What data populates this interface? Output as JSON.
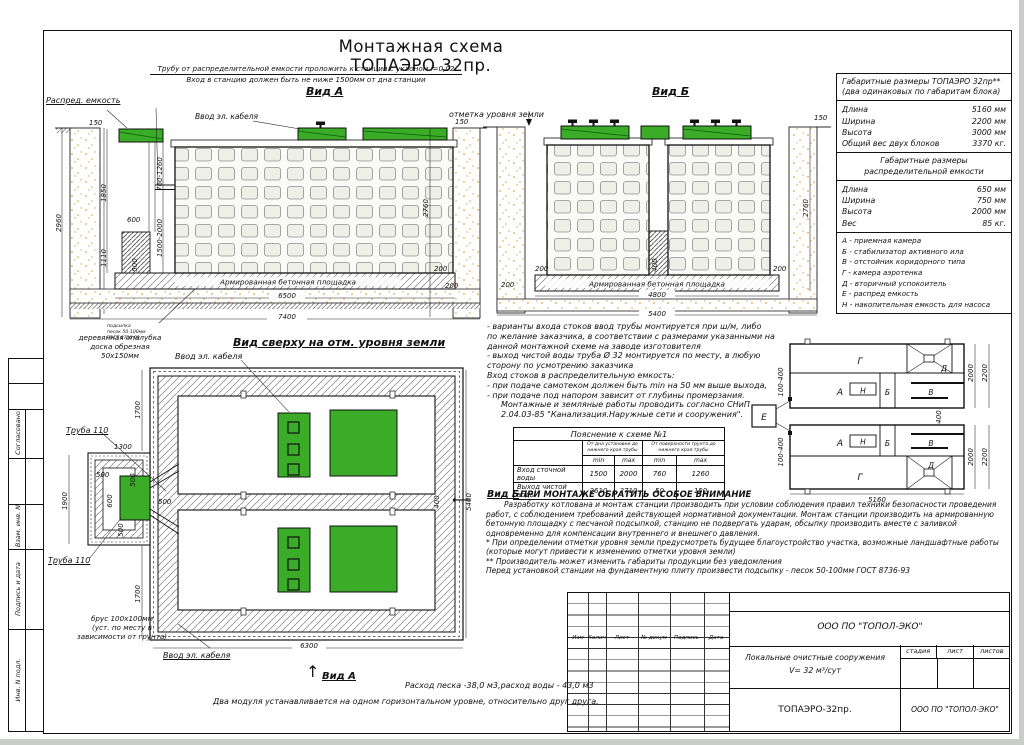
{
  "title": "Монтажная схема ТОПАЭРО 32пр.",
  "colors": {
    "green": "#3aac28"
  },
  "stamp_col": {
    "c1": "Согласовано",
    "c2": "Взам. инв. N",
    "c3": "Подпись и дата",
    "c4": "Инв. N подл."
  },
  "view_a": {
    "label": "Вид А",
    "pipe_note1": "Трубу от распределительной емкости проложить к станции с уклоном i=0,02",
    "pipe_note2": "Вход в станцию должен быть не ниже 1500мм от дна станции",
    "distrib": "Распред. емкость",
    "cable": "Ввод эл. кабеля",
    "ground": "отметка уровня земли",
    "slab": "Армированная бетонная площадка",
    "sand_note": [
      "подсыпка",
      "песок 50-100мм",
      "ГОСТ 8736-93"
    ],
    "formwork_note": [
      "деревянная опалубка",
      "доска обрезная",
      "50х150мм"
    ],
    "dims": {
      "h150l": "150",
      "v2960": "2960",
      "v1850": "1850",
      "h600": "600",
      "v1110": "1110",
      "v760": "760-1260",
      "v1500": "1500-2000",
      "v500": "500",
      "h150r": "150",
      "v2760": "2760",
      "h200a": "200",
      "h200b": "200",
      "w6500": "6500",
      "w7400": "7400"
    }
  },
  "view_b": {
    "label": "Вид Б",
    "slab": "Армированная бетонная площадка",
    "dims": {
      "h150": "150",
      "v2760": "2760",
      "h200l": "200",
      "v400": "400",
      "h200r": "200",
      "h200b": "200",
      "w4800": "4800",
      "w5400": "5400"
    }
  },
  "plan": {
    "heading": "Вид сверху на отм. уровня земли",
    "cable_top": "Ввод эл. кабеля",
    "cable_bottom": "Ввод эл. кабеля",
    "pipe1": "Труба 110",
    "pipe2": "Труба 110",
    "beam_note": [
      "брус 100х100мм",
      "(уст. по месту в",
      "зависимости от грунта)"
    ],
    "view_a_ref": "Вид А",
    "view_b_ref": "Вид Б",
    "dims": {
      "v1700t": "1700",
      "h1300": "1300",
      "h500a": "500",
      "v500b": "500",
      "v600": "600",
      "v1900": "1900",
      "v500c": "500",
      "h500d": "500",
      "v1700b": "1700",
      "v400": "400",
      "v5400": "5400",
      "w6300": "6300"
    }
  },
  "info_panel": {
    "t1_title": "Габаритные размеры ТОПАЭРО 32пр**",
    "t1_sub": "(два одинаковых по габаритам блока)",
    "t1_rows": [
      [
        "Длина",
        "5160 мм"
      ],
      [
        "Ширина",
        "2200 мм"
      ],
      [
        "Высота",
        "3000 мм"
      ],
      [
        "Общий вес двух блоков",
        "3370 кг."
      ]
    ],
    "t2_title1": "Габаритные размеры",
    "t2_title2": "распределительной емкости",
    "t2_rows": [
      [
        "Длина",
        "650 мм"
      ],
      [
        "Ширина",
        "750 мм"
      ],
      [
        "Высота",
        "2000 мм"
      ],
      [
        "Вес",
        "85 кг."
      ]
    ],
    "legend": [
      "А - приемная  камера",
      "Б - стабилизатор активного  ила",
      "В - отстойник коридорного типа",
      "Г - камера аэротенка",
      "Д - вторичный успокоитель",
      "Е - распред емкость",
      "Н - накопительная емкость для насоса"
    ]
  },
  "notes": {
    "lines": [
      "- варианты входа  стоков  ввод трубы монтируется при ш/м, либо",
      "по желание заказчика, в соответствии с размерами указанными на",
      "данной монтажной схеме на заводе изготовителя",
      "- выход чистой воды  труба Ø 32 монтируется по месту, в любую",
      "сторону по усмотрению заказчика",
      "Вход стоков в распределительную емкость:",
      "- при подаче самотеком должен быть min на 50 мм выше выхода,",
      "- при подаче под напором зависит от глубины промерзания.",
      "Монтажные и земляные работы проводить согласно СНиП",
      "2.04.03-85 \"Канализация.Наружные сети и сооружения\"."
    ]
  },
  "explain": {
    "title": "Пояснение к схеме №1",
    "g1": "От дна установки до нижнего края трубы",
    "g2": "От поверхности грунта до нижнего края трубы",
    "min1": "min",
    "max1": "max",
    "min2": "min",
    "max2": "max",
    "rows": [
      [
        "Вход сточной воды",
        "1500",
        "2000",
        "760",
        "1260"
      ],
      [
        "Выход чистой воды",
        "2610",
        "2710",
        "50",
        "150"
      ]
    ]
  },
  "attention": {
    "heading": "ПРИ МОНТАЖЕ ОБРАТИТЬ ОСОБОЕ ВНИМАНИЕ",
    "para": "Разработку котлована и монтаж станции производить при условии соблюдения правил техники безопасности проведения работ, с соблюдением требований действующей нормативной документации. Монтаж станции производить на армированную бетонную площадку с песчаной подсыпкой, станцию не подвергать ударам, обсыпку производить вместе с заливкой одновременно для компенсации внутреннего и внешнего давления.",
    "star1": "* При определении отметки уровня земли предусмотреть будущее благоустройство участка, возможные ландшафтные работы (которые могут привести к изменению отметки уровня земли)",
    "star2": "** Производитель может изменить габариты продукции без уведомления",
    "final": "Перед установкой станции на фундаментную плиту произвести подсыпку - песок 50-100мм ГОСТ  8736-93"
  },
  "schematic": {
    "e": "Е",
    "b1": {
      "g": "Г",
      "d": "Д",
      "a": "А",
      "n": "Н",
      "b": "Б",
      "v": "В"
    },
    "b2": {
      "g": "Г",
      "d": "Д",
      "a": "А",
      "n": "Н",
      "b": "Б",
      "v": "В"
    },
    "dims": {
      "r1a": "100-400",
      "r1b": "100-400",
      "d2000a": "2000",
      "d2200a": "2200",
      "d2000b": "2000",
      "d2200b": "2200",
      "v400": "400",
      "w5160": "5160"
    }
  },
  "footer": {
    "sand": "Расход песка -38,0 м3,расход воды - 43,0 м3",
    "level": "Два модуля устанавливается на одном горизонтальном уровне, относительно друг друга."
  },
  "title_block": {
    "rev_cols": [
      "Изм",
      "Колич",
      "Лист",
      "№ докум",
      "Подпись",
      "Дата"
    ],
    "company": "ООО ПО \"ТОПОЛ-ЭКО\"",
    "project1": "Локальные очистные сооружения",
    "project2": "V= 32 м³/сут",
    "stage": "стадия",
    "sheet": "лист",
    "sheets": "листов",
    "product": "ТОПАЭРО-32пр.",
    "company2": "ООО ПО \"ТОПОЛ-ЭКО\""
  }
}
